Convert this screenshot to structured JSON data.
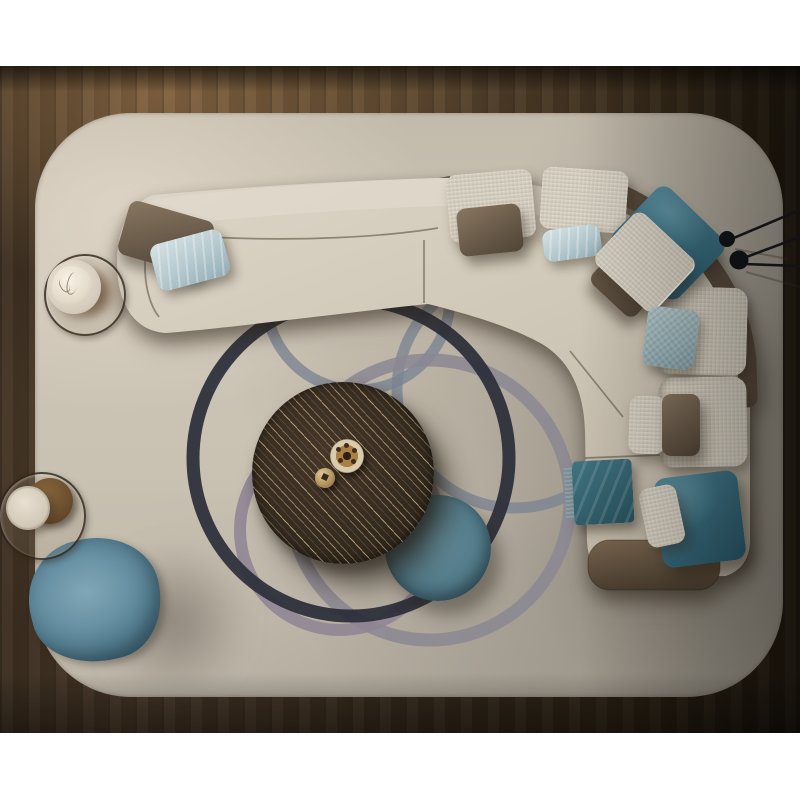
{
  "meta": {
    "label": "Top-down 3D interior render of a modern living room with L-shaped sectional sofa",
    "canvas": "800x800",
    "background": "#ffffff"
  },
  "palette": {
    "floor_dark": "#241b10",
    "floor_warm_glow": "#6f5638",
    "rug_light": "#d5cdbf",
    "rug_base": "#c8c0b2",
    "rug_shadow": "#9b958c",
    "sofa_cream": "#d4ccbd",
    "leather_taupe": "#5a4c3d",
    "teal_velvet": "#3a6e80",
    "ice_blue": "#b8cdd4",
    "pouf_steel_blue": "#6490a3",
    "table_espresso": "#332a1f",
    "brass": "#b6986a",
    "ring_black": "#2a2e38",
    "ring_slate": "#7e8694",
    "ring_mauve": "#8b8793"
  },
  "objects": {
    "floor": {
      "label": "dark walnut plank floor"
    },
    "rug": {
      "label": "cream rounded-corner area rug with overlapping ring pattern",
      "rings": [
        {
          "label": "slate ring",
          "color": "#7e8694"
        },
        {
          "label": "slate ring",
          "color": "#7a8391"
        },
        {
          "label": "mauve ring",
          "color": "#8b8793"
        },
        {
          "label": "mauve ring",
          "color": "#8e8494"
        },
        {
          "label": "black ring",
          "color": "#2a2e38"
        }
      ]
    },
    "sofa": {
      "label": "L-shaped cream sectional sofa with taupe leather shell and end cap"
    },
    "cushions": [
      {
        "label": "right backrest cushion upper"
      },
      {
        "label": "right backrest cushion lower"
      }
    ],
    "pillows": [
      {
        "label": "taupe leather pillow on left chaise",
        "color": "#6b5c4b"
      },
      {
        "label": "ice-blue pillow on left chaise",
        "color": "#b4c9ce"
      },
      {
        "label": "cream back cushion left of corner",
        "color": "#d8d1c2"
      },
      {
        "label": "cream back cushion at corner",
        "color": "#d8d1c2"
      },
      {
        "label": "taupe leather pillow top middle",
        "color": "#6b5c4b"
      },
      {
        "label": "small ice-blue pillow top middle",
        "color": "#b4c9ce"
      },
      {
        "label": "teal velvet pillow at corner",
        "color": "#3a6e80"
      },
      {
        "label": "cream pillow at corner",
        "color": "#d8d1c2"
      },
      {
        "label": "brown leather pillow at corner",
        "color": "#5f5140"
      },
      {
        "label": "blue woven pillow on right section",
        "color": "#9ab4ba"
      },
      {
        "label": "small cream pillow right section",
        "color": "#d6cfc0"
      },
      {
        "label": "brown leather pillow right section",
        "color": "#6b5c4b"
      },
      {
        "label": "large teal velvet pillow at sofa end",
        "color": "#3a6e80"
      },
      {
        "label": "small cream pillow at sofa end",
        "color": "#d5cebf"
      }
    ],
    "throw": {
      "label": "teal fringed velvet throw on seat",
      "color": "#33616d"
    },
    "coffee_table": {
      "label": "round espresso wood coffee table with diagonal grain"
    },
    "decor": [
      {
        "label": "brass perforated bowl"
      },
      {
        "label": "brass sphere"
      }
    ],
    "ottoman": {
      "label": "round teal velvet ottoman",
      "color": "#577f8d"
    },
    "pouf": {
      "label": "organic steel-blue pouf",
      "color": "#6490a3"
    },
    "side_tables": [
      {
        "label": "glass side table with white sculpture on plate"
      },
      {
        "label": "glass side table with cream vase and leather column"
      }
    ],
    "floor_lamp": {
      "label": "black two-head spider floor lamp reaching from right edge"
    }
  }
}
